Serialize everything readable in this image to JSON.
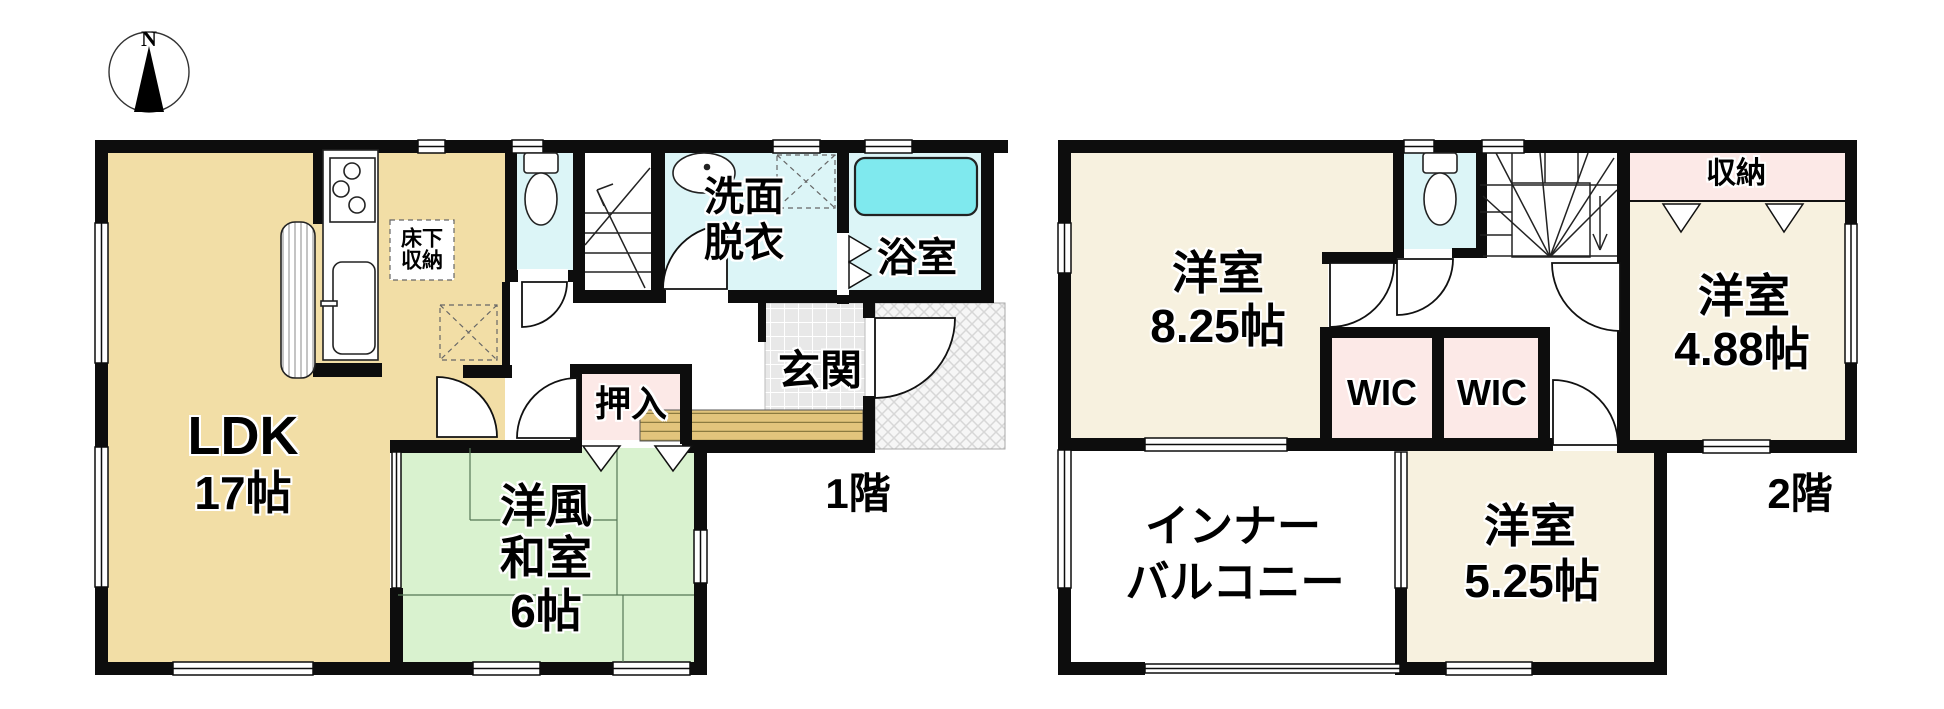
{
  "compass": {
    "north": "N"
  },
  "floor1": {
    "label": "1階",
    "ldk": {
      "name": "LDK",
      "size": "17帖"
    },
    "washitsu": {
      "line1": "洋風",
      "line2": "和室",
      "size": "6帖"
    },
    "oshiire": {
      "name": "押入"
    },
    "genkan": {
      "name": "玄関"
    },
    "senmen": {
      "line1": "洗面",
      "line2": "脱衣"
    },
    "bath": {
      "name": "浴室"
    },
    "yukashita": {
      "line1": "床下",
      "line2": "収納"
    }
  },
  "floor2": {
    "label": "2階",
    "room825": {
      "name": "洋室",
      "size": "8.25帖"
    },
    "room488": {
      "name": "洋室",
      "size": "4.88帖"
    },
    "room525": {
      "name": "洋室",
      "size": "5.25帖"
    },
    "wic1": {
      "name": "WIC"
    },
    "wic2": {
      "name": "WIC"
    },
    "shuno": {
      "name": "収納"
    },
    "balcony": {
      "line1": "インナー",
      "line2": "バルコニー"
    }
  },
  "colors": {
    "wall": "#0d0d0d",
    "ldk_fill": "#F2DEA6",
    "tatami_fill": "#D9F2CF",
    "wet_room_fill": "#DCF5F7",
    "bathtub_fill": "#7FE9EE",
    "bedroom_fill": "#F7F1DF",
    "closet_fill": "#FCE9E7",
    "entry_tile_fill": "#E8E8E8",
    "entry_step_fill": "#E2C47C"
  }
}
